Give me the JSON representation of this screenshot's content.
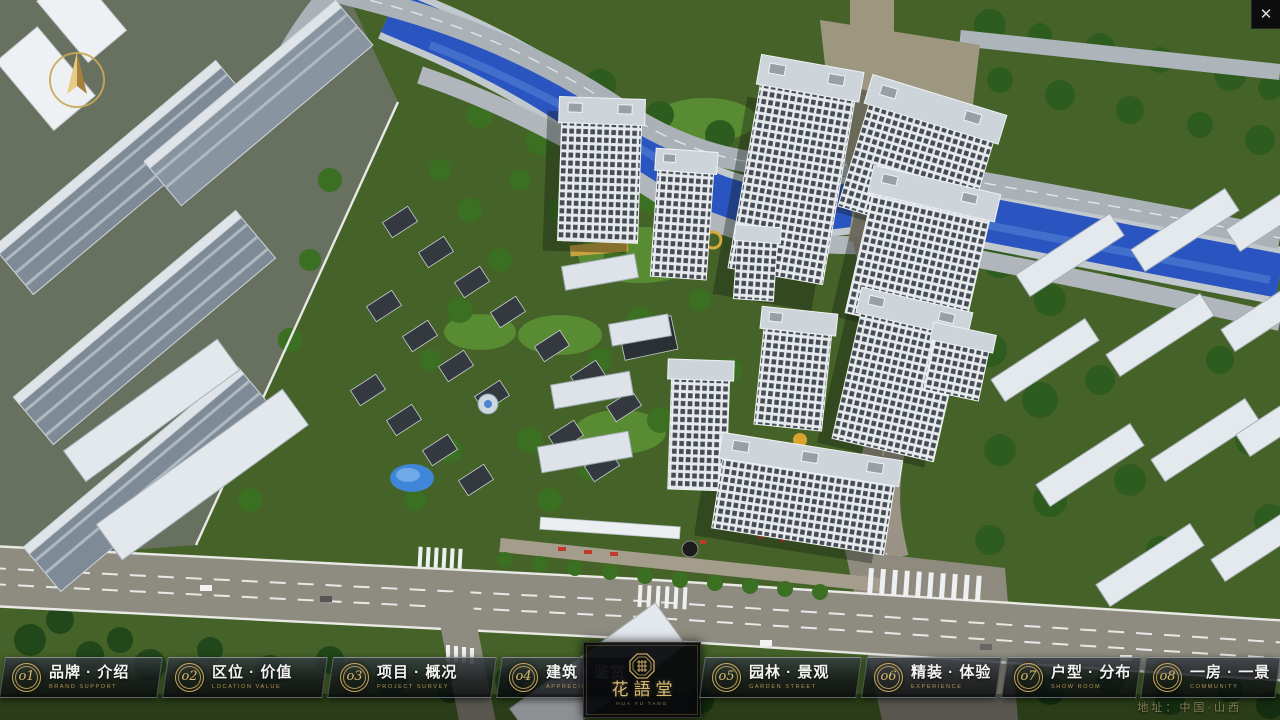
{
  "app": {
    "close_label": "✕"
  },
  "logo": {
    "name": "花語堂",
    "subtitle": "HUA YU TANG"
  },
  "nav": {
    "items": [
      {
        "num": "o1",
        "label": "品牌 · 介绍",
        "sub": "BRAND SUPPORT"
      },
      {
        "num": "o2",
        "label": "区位 · 价值",
        "sub": "LOCATION VALUE"
      },
      {
        "num": "o3",
        "label": "项目 · 概况",
        "sub": "PROJECT SURVEY"
      },
      {
        "num": "o4",
        "label": "建筑 · 鉴赏",
        "sub": "APPRECIATION"
      },
      {
        "num": "o5",
        "label": "园林 · 景观",
        "sub": "GARDEN STREET"
      },
      {
        "num": "o6",
        "label": "精装 · 体验",
        "sub": "EXPERIENCE"
      },
      {
        "num": "o7",
        "label": "户型 · 分布",
        "sub": "SHOW ROOM"
      },
      {
        "num": "o8",
        "label": "一房 · 一景",
        "sub": "COMMUNITY"
      }
    ]
  },
  "footer": {
    "address": "地址：中国·山西"
  },
  "colors": {
    "accent_gold": "#c9a85c",
    "panel_bg": "rgba(12,15,19,0.84)",
    "river_blue": "#2a55c0",
    "text_white": "#f3f3f1",
    "subtitle_gold": "#b4934e"
  }
}
